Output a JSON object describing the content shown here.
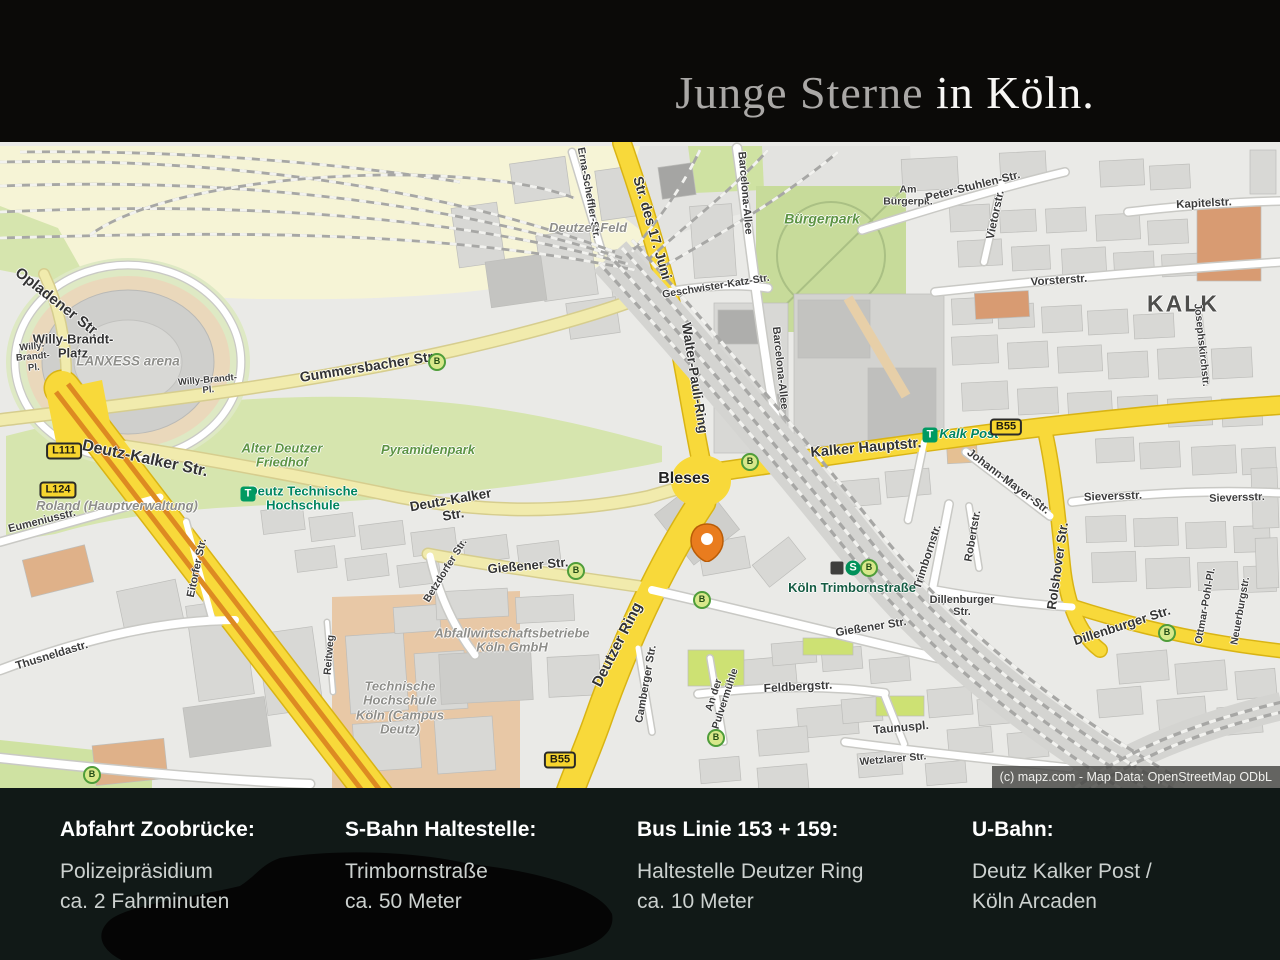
{
  "header": {
    "title_muted": "Junge Sterne",
    "title_bright": " in Köln."
  },
  "colors": {
    "road_major_yellow": "#f8d93a",
    "road_minor_yellow": "#f1ebad",
    "road_white": "#ffffff",
    "park_green": "#d6e5ae",
    "rail_cream": "#f6f4d6",
    "building_gray": "#d8d8d5",
    "pin_orange": "#e97c1e",
    "transit_green": "#009a62",
    "badge_yellow": "#f7d52e",
    "footer_bg": "#111917",
    "header_bg": "#0b0a08"
  },
  "map": {
    "copyright": "(c) mapz.com - Map Data: OpenStreetMap ODbL",
    "bus_letter": "B",
    "s_letter": "S",
    "t_letter": "T",
    "labels": [
      {
        "t": "Opladener Str.",
        "x": 57,
        "y": 303,
        "r": 38,
        "s": 15,
        "c": "street-bold"
      },
      {
        "ln": [
          "Willy-Brandt-",
          "Platz"
        ],
        "x": 73,
        "y": 347,
        "r": 0,
        "s": 13,
        "c": "street-bold"
      },
      {
        "ln": [
          "Willy-",
          "Brandt-",
          "Pl."
        ],
        "x": 33,
        "y": 358,
        "r": -5,
        "s": 9.5,
        "c": "street"
      },
      {
        "t": "LANXESS arena",
        "x": 128,
        "y": 362,
        "r": 0,
        "s": 13.5,
        "c": "poi"
      },
      {
        "ln": [
          "Willy-Brandt-",
          "Pl."
        ],
        "x": 208,
        "y": 386,
        "r": -5,
        "s": 9.5,
        "c": "street"
      },
      {
        "t": "Gummersbacher Str.",
        "x": 368,
        "y": 367,
        "r": -9,
        "s": 14,
        "c": "street-bold"
      },
      {
        "ln": [
          "Alter Deutzer",
          "Friedhof"
        ],
        "x": 282,
        "y": 456,
        "r": 0,
        "s": 13,
        "c": "park"
      },
      {
        "t": "Pyramidenpark",
        "x": 428,
        "y": 450,
        "r": 0,
        "s": 13,
        "c": "park"
      },
      {
        "ln": [
          "Deutz Technische",
          "Hochschule"
        ],
        "x": 303,
        "y": 499,
        "r": 0,
        "s": 13,
        "c": "transit"
      },
      {
        "t": "Deutz-Kalker Str.",
        "x": 145,
        "y": 459,
        "r": 12,
        "s": 16,
        "c": "street-bold"
      },
      {
        "t": "Roland (Hauptverwaltung)",
        "x": 117,
        "y": 506,
        "r": 0,
        "s": 13,
        "c": "poi"
      },
      {
        "t": "Eumeniusstr.",
        "x": 42,
        "y": 521,
        "r": -14,
        "s": 11,
        "c": "street"
      },
      {
        "ln": [
          "Deutz-Kalker",
          "Str."
        ],
        "x": 452,
        "y": 508,
        "r": -10,
        "s": 13.5,
        "c": "street-bold"
      },
      {
        "t": "Bleses",
        "x": 684,
        "y": 479,
        "r": 0,
        "s": 16,
        "c": "dest"
      },
      {
        "t": "Str. des 17. Juni",
        "x": 652,
        "y": 228,
        "r": 74,
        "s": 14,
        "c": "street-bold"
      },
      {
        "t": "Erna-Scheffler-Str.",
        "x": 588,
        "y": 193,
        "r": 80,
        "s": 10.5,
        "c": "street"
      },
      {
        "t": "Deutzer Feld",
        "x": 588,
        "y": 228,
        "r": 0,
        "s": 13,
        "c": "poi"
      },
      {
        "t": "Barcelona-Allee",
        "x": 745,
        "y": 193,
        "r": 85,
        "s": 11,
        "c": "street"
      },
      {
        "t": "Barcelona-Allee",
        "x": 780,
        "y": 368,
        "r": 84,
        "s": 11,
        "c": "street"
      },
      {
        "t": "Bürgerpark",
        "x": 822,
        "y": 219,
        "r": 0,
        "s": 14,
        "c": "park"
      },
      {
        "t": "Geschwister-Katz-Str.",
        "x": 716,
        "y": 287,
        "r": -9,
        "s": 10.5,
        "c": "street"
      },
      {
        "ln": [
          "Am",
          "Bürgerpk."
        ],
        "x": 908,
        "y": 196,
        "r": 0,
        "s": 10.5,
        "c": "street"
      },
      {
        "t": "Peter-Stuhlen-Str.",
        "x": 973,
        "y": 187,
        "r": -14,
        "s": 11.5,
        "c": "street"
      },
      {
        "t": "Vietorstr.",
        "x": 996,
        "y": 215,
        "r": -78,
        "s": 11.5,
        "c": "street"
      },
      {
        "t": "Kapitelstr.",
        "x": 1204,
        "y": 204,
        "r": -3,
        "s": 11.5,
        "c": "street"
      },
      {
        "t": "Vorsterstr.",
        "x": 1059,
        "y": 281,
        "r": -4,
        "s": 11.5,
        "c": "street"
      },
      {
        "t": "KALK",
        "x": 1183,
        "y": 304,
        "r": 0,
        "s": 23,
        "c": "district"
      },
      {
        "t": "Josephskirchstr.",
        "x": 1201,
        "y": 345,
        "r": 84,
        "s": 10.5,
        "c": "street"
      },
      {
        "t": "Walter-Pauli-Ring",
        "x": 694,
        "y": 378,
        "r": 81,
        "s": 13.5,
        "c": "street-bold"
      },
      {
        "t": "Kalker Hauptstr.",
        "x": 866,
        "y": 449,
        "r": -5,
        "s": 14.5,
        "c": "street-bold"
      },
      {
        "t": "Kalk Post",
        "x": 969,
        "y": 434,
        "r": 0,
        "s": 13,
        "c": "transit-italic"
      },
      {
        "t": "Johann-Mayer-Str.",
        "x": 1008,
        "y": 482,
        "r": 37,
        "s": 11.5,
        "c": "street"
      },
      {
        "t": "Sieversstr.",
        "x": 1113,
        "y": 497,
        "r": -2,
        "s": 11.5,
        "c": "street"
      },
      {
        "t": "Sieversstr.",
        "x": 1237,
        "y": 498,
        "r": -2,
        "s": 11,
        "c": "street"
      },
      {
        "t": "Robertstr.",
        "x": 973,
        "y": 536,
        "r": -80,
        "s": 11,
        "c": "street"
      },
      {
        "t": "Trimbornstr.",
        "x": 928,
        "y": 557,
        "r": -72,
        "s": 11.5,
        "c": "street"
      },
      {
        "t": "Köln Trimbornstraße",
        "x": 852,
        "y": 588,
        "r": 0,
        "s": 13,
        "c": "station"
      },
      {
        "ln": [
          "Dillenburger",
          "Str."
        ],
        "x": 962,
        "y": 606,
        "r": 0,
        "s": 11,
        "c": "street"
      },
      {
        "t": "Gießener Str.",
        "x": 871,
        "y": 628,
        "r": -9,
        "s": 11.5,
        "c": "street"
      },
      {
        "t": "Gießener Str.",
        "x": 528,
        "y": 566,
        "r": -5,
        "s": 13,
        "c": "street-bold"
      },
      {
        "t": "Betzdorfer Str.",
        "x": 446,
        "y": 571,
        "r": -58,
        "s": 10.5,
        "c": "street"
      },
      {
        "t": "Deutzer Ring",
        "x": 618,
        "y": 645,
        "r": -63,
        "s": 15,
        "c": "street-bold"
      },
      {
        "t": "Camberger Str.",
        "x": 646,
        "y": 684,
        "r": -80,
        "s": 11,
        "c": "street"
      },
      {
        "ln": [
          "Abfallwirtschaftsbetriebe",
          "Köln GmbH"
        ],
        "x": 512,
        "y": 641,
        "r": 0,
        "s": 13,
        "c": "poi"
      },
      {
        "ln": [
          "Technische",
          "Hochschule",
          "Köln (Campus",
          "Deutz)"
        ],
        "x": 400,
        "y": 708,
        "r": 0,
        "s": 13,
        "c": "poi"
      },
      {
        "t": "Thusneldastr.",
        "x": 52,
        "y": 656,
        "r": -17,
        "s": 11.5,
        "c": "street"
      },
      {
        "t": "Eitorfer Str.",
        "x": 197,
        "y": 568,
        "r": -78,
        "s": 11,
        "c": "street"
      },
      {
        "t": "Reitweg",
        "x": 330,
        "y": 655,
        "r": -85,
        "s": 10.5,
        "c": "street"
      },
      {
        "ln": [
          "An der",
          "Pulvermühle"
        ],
        "x": 720,
        "y": 697,
        "r": -72,
        "s": 10.5,
        "c": "street"
      },
      {
        "t": "Feldbergstr.",
        "x": 798,
        "y": 687,
        "r": -3,
        "s": 12,
        "c": "street"
      },
      {
        "t": "Taunuspl.",
        "x": 901,
        "y": 728,
        "r": -5,
        "s": 12,
        "c": "street"
      },
      {
        "t": "Wetzlarer Str.",
        "x": 893,
        "y": 760,
        "r": -5,
        "s": 10.5,
        "c": "street"
      },
      {
        "t": "Dillenburger Str.",
        "x": 1122,
        "y": 626,
        "r": -18,
        "s": 13,
        "c": "street-bold"
      },
      {
        "t": "Rolshover Str.",
        "x": 1058,
        "y": 566,
        "r": -82,
        "s": 13,
        "c": "street-bold"
      },
      {
        "t": "Ottmar-Pohl-Pl.",
        "x": 1206,
        "y": 606,
        "r": -80,
        "s": 10.5,
        "c": "street"
      },
      {
        "t": "Neuerburgstr.",
        "x": 1241,
        "y": 611,
        "r": -80,
        "s": 10.5,
        "c": "street"
      }
    ],
    "bus_badges": [
      {
        "x": 437,
        "y": 362
      },
      {
        "x": 750,
        "y": 462
      },
      {
        "x": 576,
        "y": 571
      },
      {
        "x": 702,
        "y": 600
      },
      {
        "x": 869,
        "y": 568
      },
      {
        "x": 1167,
        "y": 633
      },
      {
        "x": 716,
        "y": 738
      },
      {
        "x": 92,
        "y": 775
      }
    ],
    "route_badges": [
      {
        "text": "L111",
        "x": 64,
        "y": 451
      },
      {
        "text": "L124",
        "x": 58,
        "y": 490
      },
      {
        "text": "B55",
        "x": 1006,
        "y": 427
      },
      {
        "text": "B55",
        "x": 560,
        "y": 760
      }
    ],
    "t_badges": [
      {
        "x": 248,
        "y": 494
      },
      {
        "x": 930,
        "y": 435
      }
    ],
    "s_badge": {
      "x": 853,
      "y": 568
    },
    "station_square": {
      "x": 837,
      "y": 568
    },
    "pin": {
      "x": 690,
      "y": 522
    }
  },
  "footer": {
    "columns": [
      {
        "heading": "Abfahrt Zoobrücke:",
        "lines": [
          "Polizeipräsidium",
          "ca. 2 Fahrminuten"
        ]
      },
      {
        "heading": "S-Bahn Haltestelle:",
        "lines": [
          "Trimbornstraße",
          "ca. 50 Meter"
        ]
      },
      {
        "heading": "Bus Linie 153 + 159:",
        "lines": [
          "Haltestelle Deutzer Ring",
          "ca. 10 Meter"
        ]
      },
      {
        "heading": "U-Bahn:",
        "lines": [
          "Deutz Kalker Post /",
          "Köln Arcaden"
        ]
      }
    ]
  }
}
